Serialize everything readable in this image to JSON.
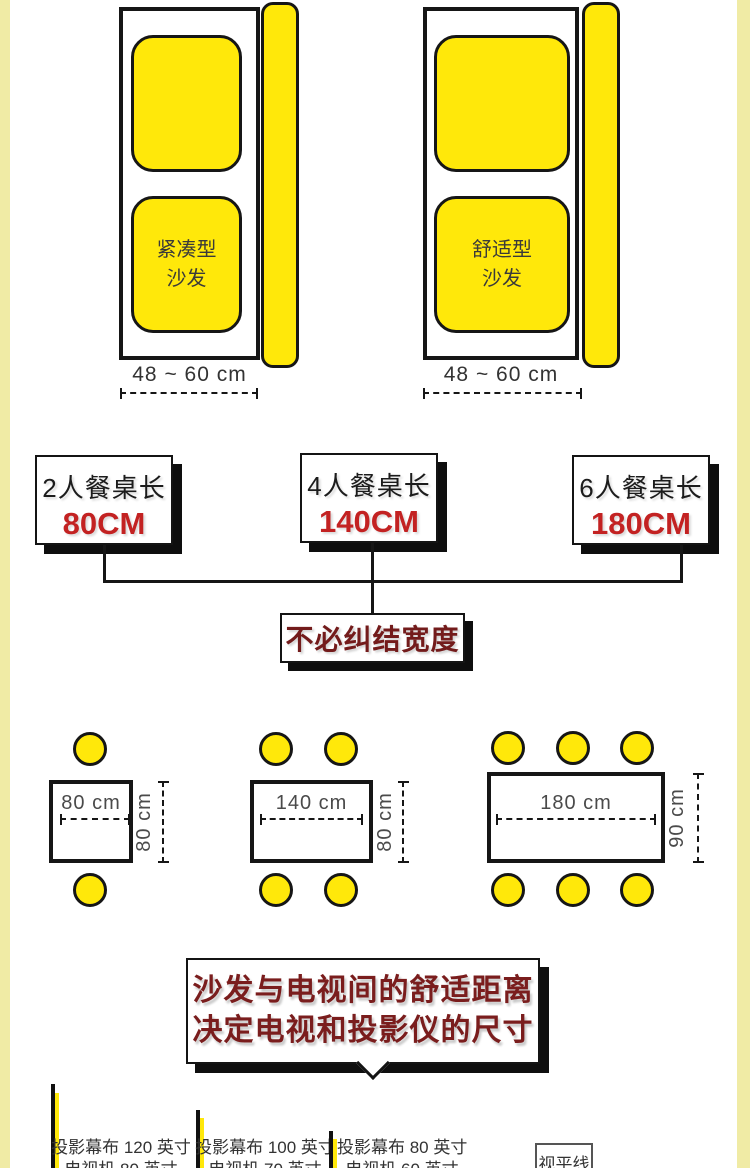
{
  "colors": {
    "accent_yellow": "#ffe80a",
    "pale_side_strip": "#f0eba5",
    "outline_black": "#161616",
    "value_red": "#c32222",
    "headline_dark_red": "#7a1d1d",
    "dim_text_gray": "#3a3a3a"
  },
  "sofas": [
    {
      "label_line1": "紧凑型",
      "label_line2": "沙发",
      "depth_label": "48 ~ 60 cm"
    },
    {
      "label_line1": "舒适型",
      "label_line2": "沙发",
      "depth_label": "48 ~ 60 cm"
    }
  ],
  "table_length_boxes": [
    {
      "title": "2人餐桌长",
      "value": "80CM"
    },
    {
      "title": "4人餐桌长",
      "value": "140CM"
    },
    {
      "title": "6人餐桌长",
      "value": "180CM"
    }
  ],
  "width_note": "不必纠结宽度",
  "tables": [
    {
      "seats": 2,
      "length_label": "80 cm",
      "depth_label": "80 cm"
    },
    {
      "seats": 4,
      "length_label": "140 cm",
      "depth_label": "80 cm"
    },
    {
      "seats": 6,
      "length_label": "180 cm",
      "depth_label": "90 cm"
    }
  ],
  "tv_section": {
    "headline_line1": "沙发与电视间的舒适距离",
    "headline_line2": "决定电视和投影仪的尺寸",
    "screens": [
      {
        "line1": "投影幕布 120 英寸",
        "line2": "电视机 80 英寸"
      },
      {
        "line1": "投影幕布 100 英寸",
        "line2": "电视机 70 英寸"
      },
      {
        "line1": "投影幕布 80 英寸",
        "line2": "电视机 60 英寸"
      }
    ],
    "eye_level_label": "视平线"
  }
}
